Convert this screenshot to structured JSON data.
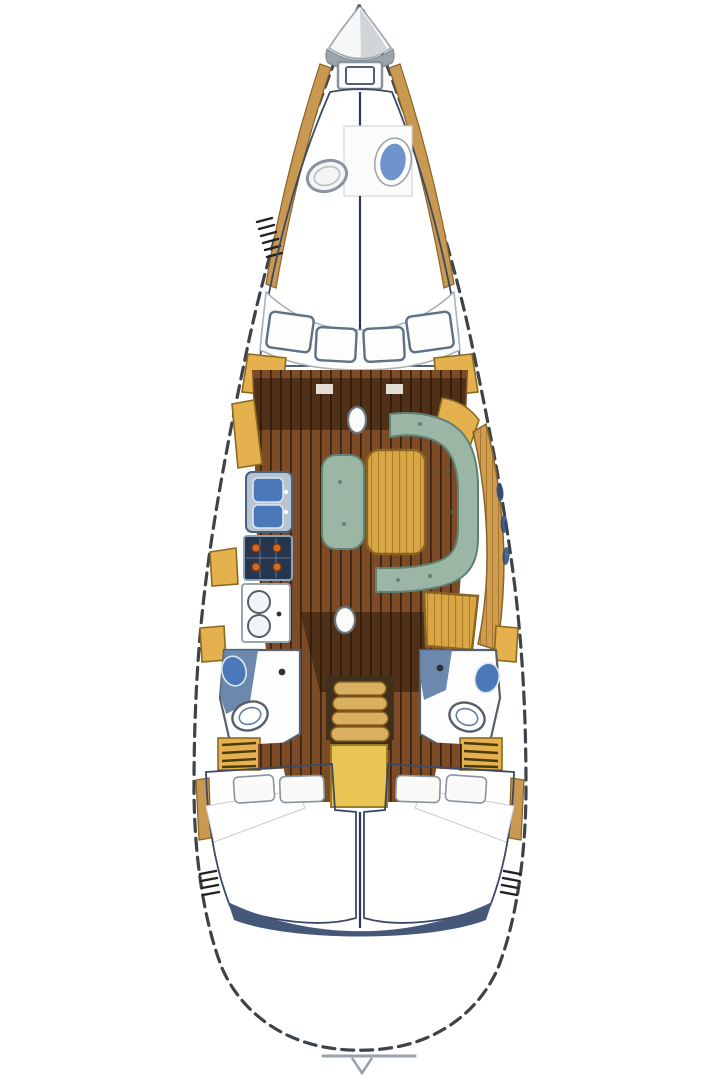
{
  "boat": {
    "view": "top-down-interior-plan",
    "sections": [
      {
        "id": "bow",
        "label": "Bow with anchor locker and foredeck hatch"
      },
      {
        "id": "forward-cabin",
        "label": "Forward cabin V-berth with porthole and deck hatch"
      },
      {
        "id": "forward-seat",
        "label": "Curved forward seat with four cushions and side lockers"
      },
      {
        "id": "salon",
        "label": "Main salon with U-shaped settee, table and centerline bench"
      },
      {
        "id": "galley",
        "label": "Port galley with double sink, stove and counter"
      },
      {
        "id": "nav-station",
        "label": "Starboard navigation desk"
      },
      {
        "id": "heads",
        "label": "Port and starboard heads with toilet and basin"
      },
      {
        "id": "companionway",
        "label": "Companionway steps over engine compartment"
      },
      {
        "id": "aft-cabins",
        "label": "Twin aft double cabins with berths and pillows"
      },
      {
        "id": "stern",
        "label": "Stern transom with swim notch"
      }
    ]
  },
  "palette": {
    "hull_outline": "#3d4349",
    "anchor_gray": "#9aa4aa",
    "cone_shade": "#c4cad0",
    "rail_tan": "#c99952",
    "rail_line": "#8a6428",
    "berth_base": "#86a2d8",
    "berth_dark": "#3a5ea6",
    "berth_light": "#bccde9",
    "berth_seam": "#2a3a55",
    "pillow": "#fafaf8",
    "pillow_stroke": "#8a94a0",
    "seat_white": "#fdfdfc",
    "cushion_stroke": "#5d7187",
    "floor_base": "#7d4c26",
    "floor_line": "#3a2210",
    "shadow_brown": "rgba(35,20,8,0.5)",
    "table_base": "#d9a646",
    "table_line": "#b07c28",
    "table_stroke": "#8a6420",
    "locker_yellow": "#e4b14e",
    "locker_stroke": "#8a6a1e",
    "settee_green": "#9cb6a6",
    "settee_stroke": "#5f8272",
    "settee_speck": "#47695a",
    "sink_blue": "#4a78b8",
    "sink_panel": "#b8c4d2",
    "unit_stroke": "#45627e",
    "stove_navy": "#27364f",
    "stove_stroke": "#8fa3b8",
    "burner_orange": "#d86a20",
    "burner_stroke": "#7a3a08",
    "counter_stroke": "#98a4ae",
    "slate": "#5f7fa6",
    "head_wall": "#55606a",
    "engine_yellow": "#e9c554",
    "engine_stroke": "#9a7a22",
    "step_tan": "#d8b060",
    "step_stroke": "#8a6420",
    "recess_brown": "#40301c",
    "window_navy": "#2e4a7a",
    "slate_band": "#46587a",
    "transom_gray": "#9aa2a8",
    "comb_dark": "#222222"
  }
}
